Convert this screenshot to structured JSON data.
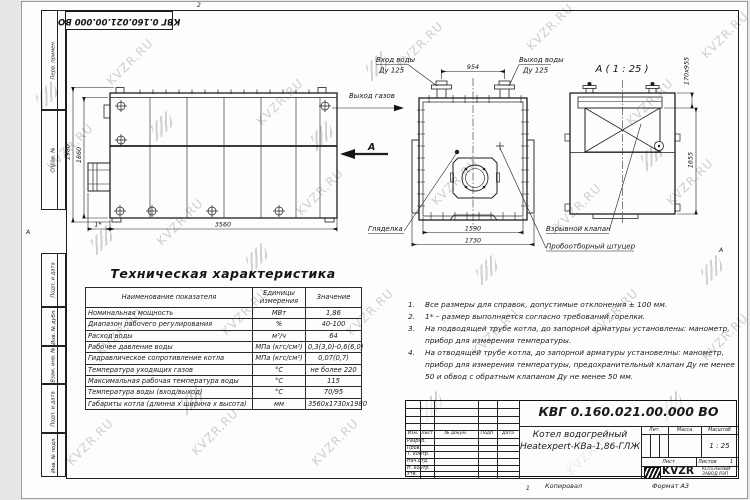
{
  "watermark": {
    "text": "KVZR.RU"
  },
  "frame": {
    "doc_number_top": "КВГ 0.160.021.00.000 ВО",
    "stamps_left": [
      "Перв. примен.",
      "Справ. №",
      "Подп. и дата",
      "Инв. № дубл.",
      "Взам. инв. №",
      "Подп. и дата",
      "Инв. № подл."
    ],
    "zone_top": "2",
    "zone_bottom": "1",
    "zone_left": "А",
    "zone_right": "А",
    "footer_copy": "Копировал",
    "footer_format": "Формат А3"
  },
  "views": {
    "side": {
      "dims": {
        "height_outer": "1980",
        "height_inner": "1860",
        "length": "3560",
        "burner": "1*"
      }
    },
    "front": {
      "labels": {
        "water_in": "Вход воды",
        "water_in_dn": "Ду 125",
        "water_out": "Выход воды",
        "water_out_dn": "Ду 125",
        "gas_out": "Выход газов",
        "view_arrow": "А",
        "sight_glass": "Гляделка"
      },
      "dims": {
        "stub_spacing": "954",
        "width_inner": "1590",
        "width_outer": "1730"
      }
    },
    "section": {
      "title": "А ( 1 : 25 )",
      "labels": {
        "explosion_valve": "Взрывной клапан",
        "sampling_fitting": "Пробоотборный штуцер"
      },
      "dims": {
        "top": "170х955",
        "height": "1655"
      }
    }
  },
  "spec_table": {
    "title": "Техническая характеристика",
    "headers": [
      "Наименование показателя",
      "Единицы измерения",
      "Значение"
    ],
    "rows": [
      [
        "Номинальная мощность",
        "МВт",
        "1,86"
      ],
      [
        "Диапазон рабочего регулирования",
        "%",
        "40-100"
      ],
      [
        "Расход воды",
        "м³/ч",
        "64"
      ],
      [
        "Рабочее давление воды",
        "МПа (кгс/см²)",
        "0,3(3,0)-0,6(6,0)"
      ],
      [
        "Гидравлическое сопротивление котла",
        "МПа (кгс/см²)",
        "0,07(0,7)"
      ],
      [
        "Температура уходящих газов",
        "°С",
        "не более 220"
      ],
      [
        "Максимальная рабочая температура воды",
        "°С",
        "115"
      ],
      [
        "Температура воды (вход/выход)",
        "°С",
        "70/95"
      ],
      [
        "Габариты котла (длинна х ширина х высота)",
        "мм",
        "3560х1730х1980"
      ]
    ]
  },
  "notes": {
    "items": [
      {
        "num": "1.",
        "text": "Все размеры для справок, допустимые отклонения ± 100 мм."
      },
      {
        "num": "2.",
        "text": "1* – размер выполняется согласно требований горелки."
      },
      {
        "num": "3.",
        "text": "На подводящей трубе котла, до запорной арматуры установлены: манометр, прибор для измерения температуры."
      },
      {
        "num": "4.",
        "text": "На отводящей трубе котла, до запорной арматуры установелны: манометр, прибор для измерения температуры, предохранительный клапан Ду не менее 50 и обвод с обратным клапаном Ду не менее 50 мм."
      }
    ]
  },
  "title_block": {
    "doc_number": "КВГ 0.160.021.00.000 ВО",
    "product_name_line1": "Котел водогрейный",
    "product_name_line2": "Heatexpert-КВа-1,86-ГЛЖ",
    "header_row": [
      "Изм.",
      "Лист",
      "№ докум.",
      "Подп.",
      "Дата"
    ],
    "row_labels": [
      "Разраб.",
      "Пров.",
      "Т. контр.",
      "Нач.отд.",
      "Н. контр.",
      "Утв."
    ],
    "lit_label": "Лит.",
    "mass_label": "Масса",
    "scale_label": "Масштаб",
    "scale_value": "1 : 25",
    "sheet_label": "Лист",
    "sheets_label": "Листов",
    "sheets_value": "1",
    "logo_text": "KVZR",
    "logo_sub1": "КОТЕЛЬНЫЙ",
    "logo_sub2": "ЗАВОД РЭП"
  }
}
